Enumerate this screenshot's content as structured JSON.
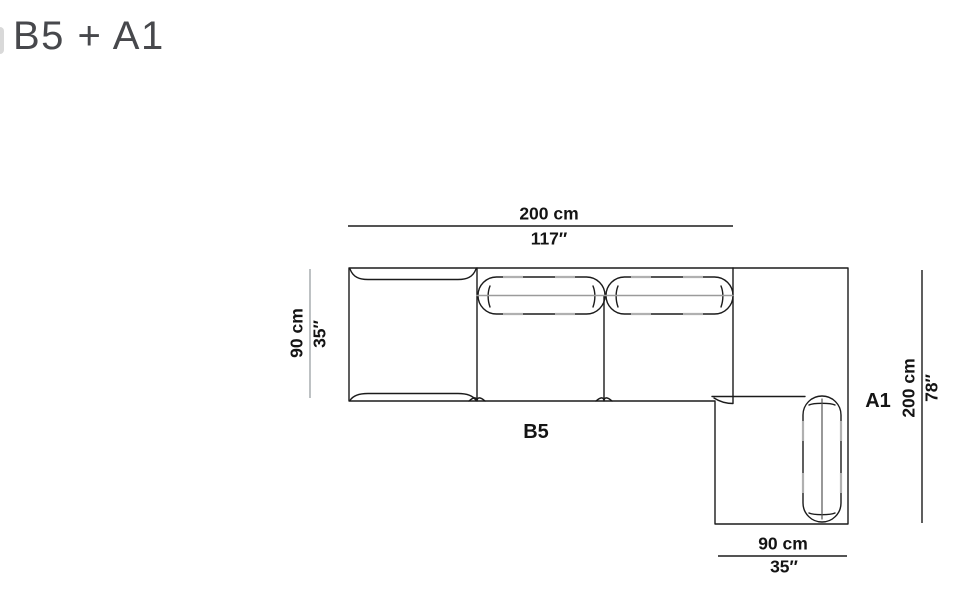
{
  "page": {
    "title": "B5 + A1"
  },
  "modules": {
    "b5": "B5",
    "a1": "A1"
  },
  "dimensions": {
    "top": {
      "cm": "200 cm",
      "inch": "117″"
    },
    "left": {
      "cm": "90 cm",
      "inch": "35″"
    },
    "right": {
      "cm": "200 cm",
      "inch": "78″"
    },
    "bottom": {
      "cm": "90 cm",
      "inch": "35″"
    }
  },
  "colors": {
    "outline": "#1b1b1b",
    "seam_gray": "#9b9b9b",
    "dash_gray": "#b0b0b0",
    "left_dim_line": "#9aa0a3",
    "title_gray": "#47484c"
  }
}
